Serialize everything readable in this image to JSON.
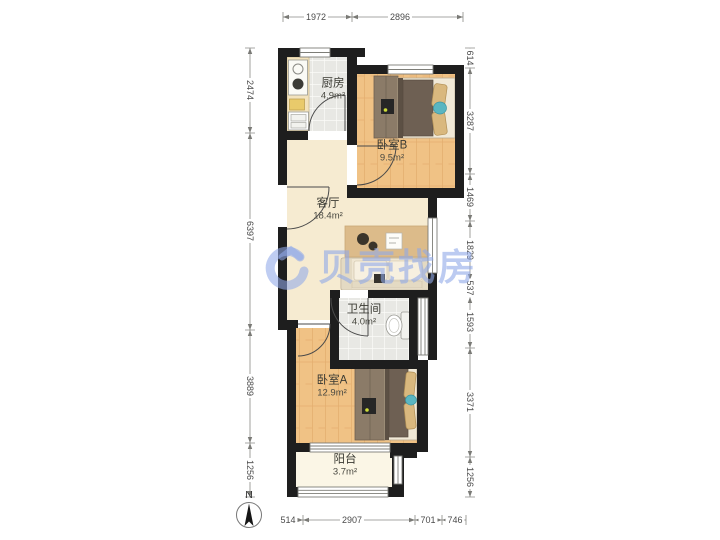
{
  "title": "apartment floor plan",
  "watermark": {
    "text": "贝壳找房",
    "accent_color": "#90a9e8"
  },
  "compass": {
    "label": "N"
  },
  "rooms": {
    "kitchen": {
      "name": "厨房",
      "area": "4.9m²"
    },
    "bedroomB": {
      "name": "卧室B",
      "area": "9.5m²"
    },
    "living": {
      "name": "客厅",
      "area": "18.4m²"
    },
    "bathroom": {
      "name": "卫生间",
      "area": "4.0m²"
    },
    "bedroomA": {
      "name": "卧室A",
      "area": "12.9m²"
    },
    "balcony": {
      "name": "阳台",
      "area": "3.7m²"
    }
  },
  "dims": {
    "top": [
      "1972",
      "2896"
    ],
    "bottom": [
      "514",
      "2907",
      "701",
      "746"
    ],
    "left": [
      "2474",
      "6397",
      "3889",
      "1256"
    ],
    "right": [
      "614",
      "3287",
      "1469",
      "1829",
      "537",
      "1593",
      "3371",
      "1256"
    ]
  },
  "colors": {
    "wall": "#1e1e1e",
    "wood_floor": "#f0c285",
    "tile_floor": "#e8e8e4",
    "living_floor": "#f6ebd1",
    "balcony_floor": "#fbf6e6",
    "dimension_text": "#4b4b4b"
  }
}
